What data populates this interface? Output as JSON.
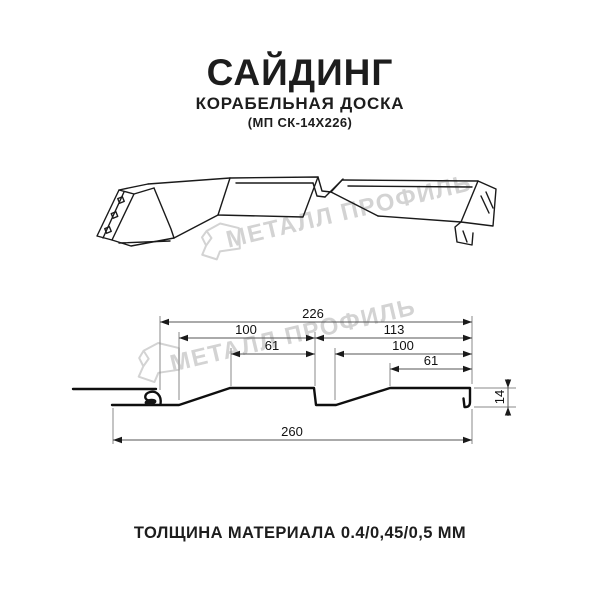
{
  "header": {
    "title": "САЙДИНГ",
    "subtitle": "КОРАБЕЛЬНАЯ ДОСКА",
    "model_code": "(МП СК-14Х226)"
  },
  "watermark": {
    "brand": "МЕТАЛЛ ПРОФИЛЬ",
    "color": "#d3d3d3"
  },
  "diagram": {
    "type": "technical-drawing",
    "dimensions": {
      "top_overall": "226",
      "left_pitch": "100",
      "right_pitch": "113",
      "left_face": "61",
      "right_inner": "100",
      "right_face": "61",
      "bottom_overall": "260",
      "height": "14"
    }
  },
  "footer": {
    "thickness_note": "ТОЛЩИНА МАТЕРИАЛА 0.4/0,45/0,5 ММ"
  }
}
